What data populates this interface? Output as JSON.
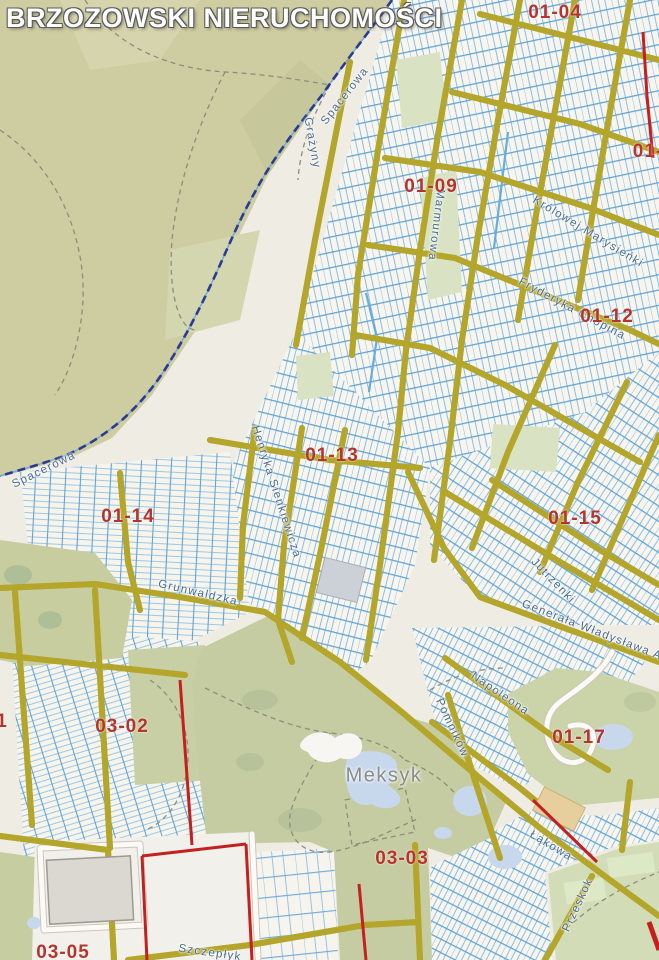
{
  "map": {
    "watermark": "BRZOZOWSKI NIERUCHOMOŚCI",
    "place_name": "Meksyk",
    "labels": [
      {
        "type": "street",
        "text": "Spacerowa",
        "x": 345,
        "y": 96,
        "rot": -52
      },
      {
        "type": "street",
        "text": "Spacerowa",
        "x": 44,
        "y": 470,
        "rot": -26
      },
      {
        "type": "street",
        "text": "Grażyny",
        "x": 312,
        "y": 143,
        "rot": 80
      },
      {
        "type": "street",
        "text": "Marmurowa",
        "x": 436,
        "y": 225,
        "rot": 97
      },
      {
        "type": "street",
        "text": "Królowej Marysieńki",
        "x": 588,
        "y": 232,
        "rot": 31
      },
      {
        "type": "street",
        "text": "Fryderyka Chopina",
        "x": 572,
        "y": 309,
        "rot": 28
      },
      {
        "type": "street",
        "text": "Henryka Sienkiewicza",
        "x": 276,
        "y": 492,
        "rot": 72
      },
      {
        "type": "street",
        "text": "Grunwaldzka",
        "x": 198,
        "y": 593,
        "rot": 13
      },
      {
        "type": "street",
        "text": "Jutrzenki",
        "x": 553,
        "y": 581,
        "rot": 46
      },
      {
        "type": "street",
        "text": "Generała Władysława Andersa",
        "x": 612,
        "y": 638,
        "rot": 21
      },
      {
        "type": "street",
        "text": "Napoleona",
        "x": 500,
        "y": 694,
        "rot": 34
      },
      {
        "type": "street",
        "text": "Pomników",
        "x": 452,
        "y": 728,
        "rot": 65
      },
      {
        "type": "street",
        "text": "Łąkowa",
        "x": 551,
        "y": 846,
        "rot": 31
      },
      {
        "type": "street",
        "text": "Przeskok",
        "x": 578,
        "y": 905,
        "rot": -65
      },
      {
        "type": "street",
        "text": "Szczepłyk",
        "x": 210,
        "y": 953,
        "rot": 8
      },
      {
        "type": "place",
        "text": "Meksyk",
        "x": 384,
        "y": 776,
        "rot": 0
      },
      {
        "type": "zone",
        "text": "01-04",
        "x": 555,
        "y": 13,
        "rot": 0
      },
      {
        "type": "zone",
        "text": "01-09",
        "x": 431,
        "y": 187,
        "rot": 0
      },
      {
        "type": "zone",
        "text": "01-12",
        "x": 607,
        "y": 317,
        "rot": 0
      },
      {
        "type": "zone",
        "text": "01-13",
        "x": 332,
        "y": 456,
        "rot": 0
      },
      {
        "type": "zone",
        "text": "01-14",
        "x": 128,
        "y": 517,
        "rot": 0
      },
      {
        "type": "zone",
        "text": "01-15",
        "x": 575,
        "y": 519,
        "rot": 0
      },
      {
        "type": "zone",
        "text": "01-17",
        "x": 579,
        "y": 738,
        "rot": 0
      },
      {
        "type": "zone",
        "text": "03-02",
        "x": 122,
        "y": 727,
        "rot": 0
      },
      {
        "type": "zone",
        "text": "03-03",
        "x": 402,
        "y": 859,
        "rot": 0
      },
      {
        "type": "zone",
        "text": "03-05",
        "x": 63,
        "y": 953,
        "rot": 0
      },
      {
        "type": "zone",
        "text": "1",
        "x": 2,
        "y": 722,
        "rot": 0
      },
      {
        "type": "zone",
        "text": "01-",
        "x": 648,
        "y": 152,
        "rot": 0
      }
    ],
    "colors": {
      "watermark_text": "#ffffff",
      "watermark_outline": "#5a5a5a",
      "zone_label": "#b5342c",
      "street_label": "#4a6b8c",
      "place_label": "#8b8b8b",
      "road_yellow": "#f2e358",
      "road_casing": "#b4a62b",
      "parcel_line": "#7db9e6",
      "urban_cream": "#f8f5ee",
      "forest_green": "#cecca1",
      "field_green": "#c5cca1",
      "water_blue": "#c7d8ec",
      "boundary_red": "#c42020",
      "boundary_navy": "#2c3a90"
    }
  }
}
